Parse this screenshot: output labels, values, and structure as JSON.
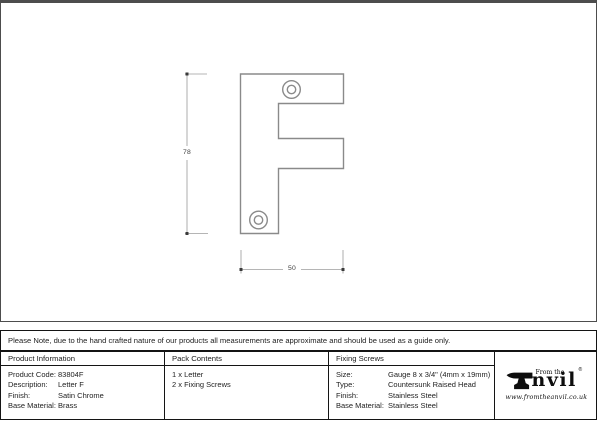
{
  "drawing": {
    "height_dimension": "78",
    "width_dimension": "50"
  },
  "note": {
    "text": "Please Note, due to the hand crafted nature of our products all measurements are approximate and should be used as a guide only."
  },
  "table": {
    "product_information": {
      "header": "Product Information",
      "rows": [
        {
          "label": "Product Code:",
          "value": "83804F"
        },
        {
          "label": "Description:",
          "value": "Letter F"
        },
        {
          "label": "Finish:",
          "value": "Satin Chrome"
        },
        {
          "label": "Base Material:",
          "value": "Brass"
        }
      ]
    },
    "pack_contents": {
      "header": "Pack Contents",
      "items": [
        "1 x Letter",
        "2 x Fixing Screws"
      ]
    },
    "fixing_screws": {
      "header": "Fixing Screws",
      "rows": [
        {
          "label": "Size:",
          "value": "Gauge 8 x 3/4\" (4mm x 19mm)"
        },
        {
          "label": "Type:",
          "value": "Countersunk Raised Head"
        },
        {
          "label": "Finish:",
          "value": "Stainless Steel"
        },
        {
          "label": "Base Material:",
          "value": "Stainless Steel"
        }
      ]
    }
  },
  "logo": {
    "tagline": "From the",
    "brand_suffix": "nvil",
    "registered_mark": "®",
    "website": "www.fromtheanvil.co.uk"
  },
  "colors": {
    "panel_border": "#4d4d4d",
    "table_border": "#141414",
    "drawing_line": "#8a8a8a",
    "dimension_line": "#b5b5b5",
    "dimension_tick": "#3a3a3a",
    "logo_black": "#0d0d0d"
  }
}
